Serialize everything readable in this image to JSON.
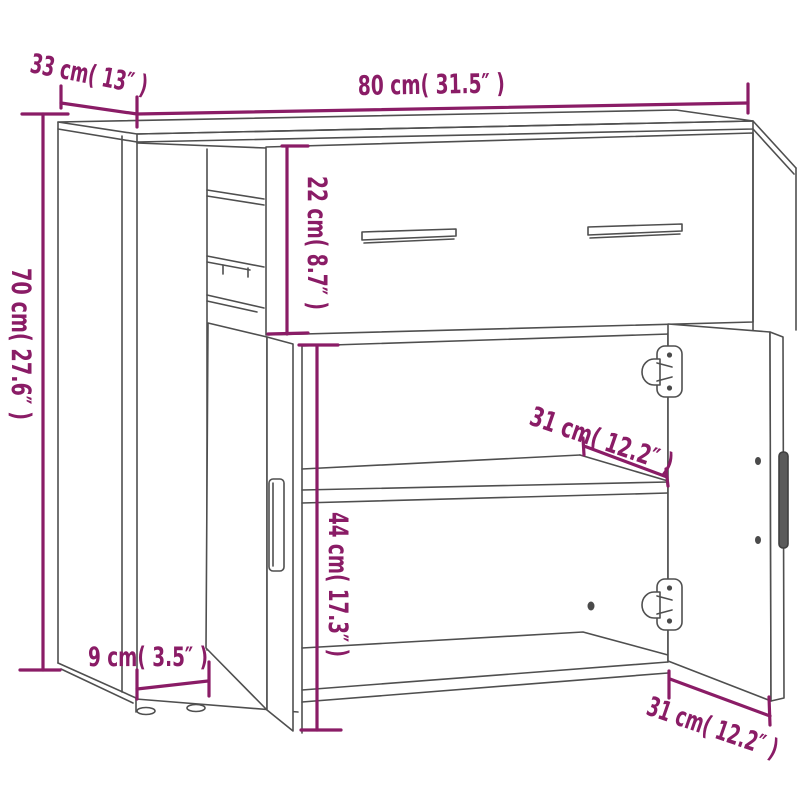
{
  "diagram": {
    "type": "furniture-dimension-drawing",
    "subject": "sideboard cabinet with drawer, two doors and shelf",
    "colors": {
      "dimension": "#8a1c66",
      "outline": "#4f4f4f",
      "background": "#ffffff"
    },
    "dims": {
      "width": {
        "cm": "80",
        "inch": "31.5",
        "label": "80 cm( 31.5″ )"
      },
      "depth": {
        "cm": "33",
        "inch": "13",
        "label": "33 cm( 13″ )"
      },
      "height": {
        "cm": "70",
        "inch": "27.6",
        "label": "70 cm( 27.6″ )"
      },
      "drawer_height": {
        "cm": "22",
        "inch": "8.7",
        "label": "22 cm( 8.7″ )"
      },
      "shelf_depth": {
        "cm": "31",
        "inch": "12.2",
        "label": "31 cm( 12.2″ )"
      },
      "compartment_height": {
        "cm": "44",
        "inch": "17.3",
        "label": "44 cm( 17.3″ )"
      },
      "plinth_height": {
        "cm": "9",
        "inch": "3.5",
        "label": "9 cm( 3.5″ )"
      },
      "door_width": {
        "cm": "31",
        "inch": "12.2",
        "label": "31 cm( 12.2″ )"
      }
    }
  }
}
